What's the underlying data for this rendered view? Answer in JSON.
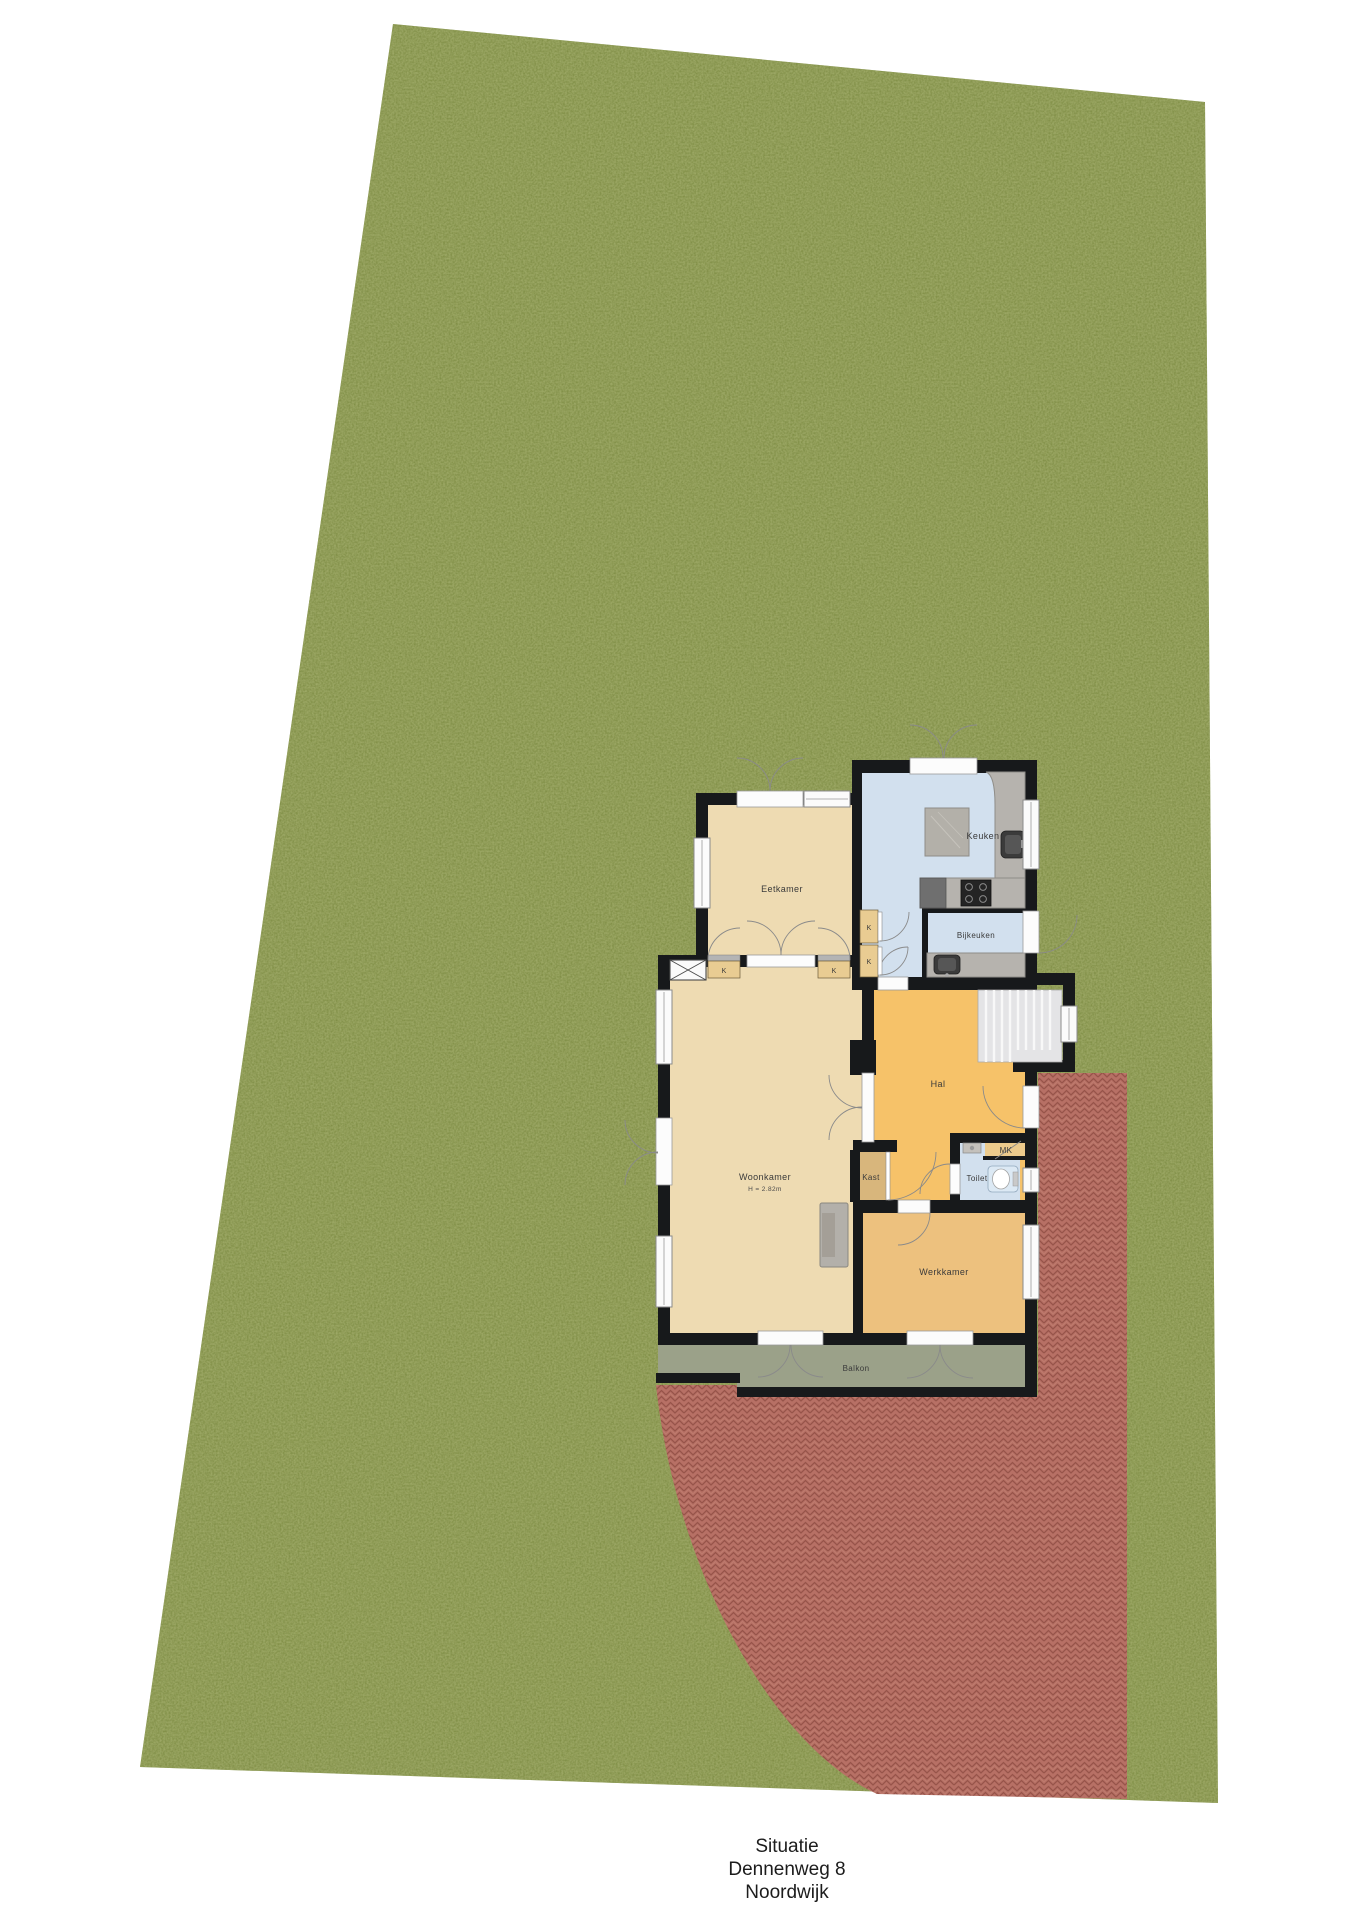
{
  "caption": {
    "line1": "Situatie",
    "line2": "Dennenweg 8",
    "line3": "Noordwijk"
  },
  "plan": {
    "labels": {
      "eetkamer": "Eetkamer",
      "keuken": "Keuken",
      "bijkeuken": "Bijkeuken",
      "hal": "Hal",
      "woonkamer": "Woonkamer",
      "woonkamer_ceiling_height": "H = 2.82m",
      "kast": "Kast",
      "toilet": "Toilet",
      "meterkast": "MK",
      "werkkamer": "Werkkamer",
      "balkon": "Balkon",
      "closet": "K"
    }
  },
  "palette": {
    "grass": "#79883e",
    "grass_speckle": "#66762c",
    "terrace": "#b77065",
    "terrace_joint": "#97544a",
    "wall": "#17191b",
    "floor_tan": "#eedbb2",
    "floor_orange_hal": "#f6c269",
    "floor_orange_werkkamer": "#edc17e",
    "floor_blue": "#d2e0ee",
    "floor_kast": "#d8b67c",
    "floor_closet": "#e9cc92",
    "floor_meterkast": "#ecca8c",
    "floor_balkon": "#9ba189",
    "stairs": "#e4e4e6",
    "counter": "#b6b3ae",
    "label_text": "#3a3a3a",
    "caption_text": "#1c1c1c",
    "background": "#ffffff"
  }
}
